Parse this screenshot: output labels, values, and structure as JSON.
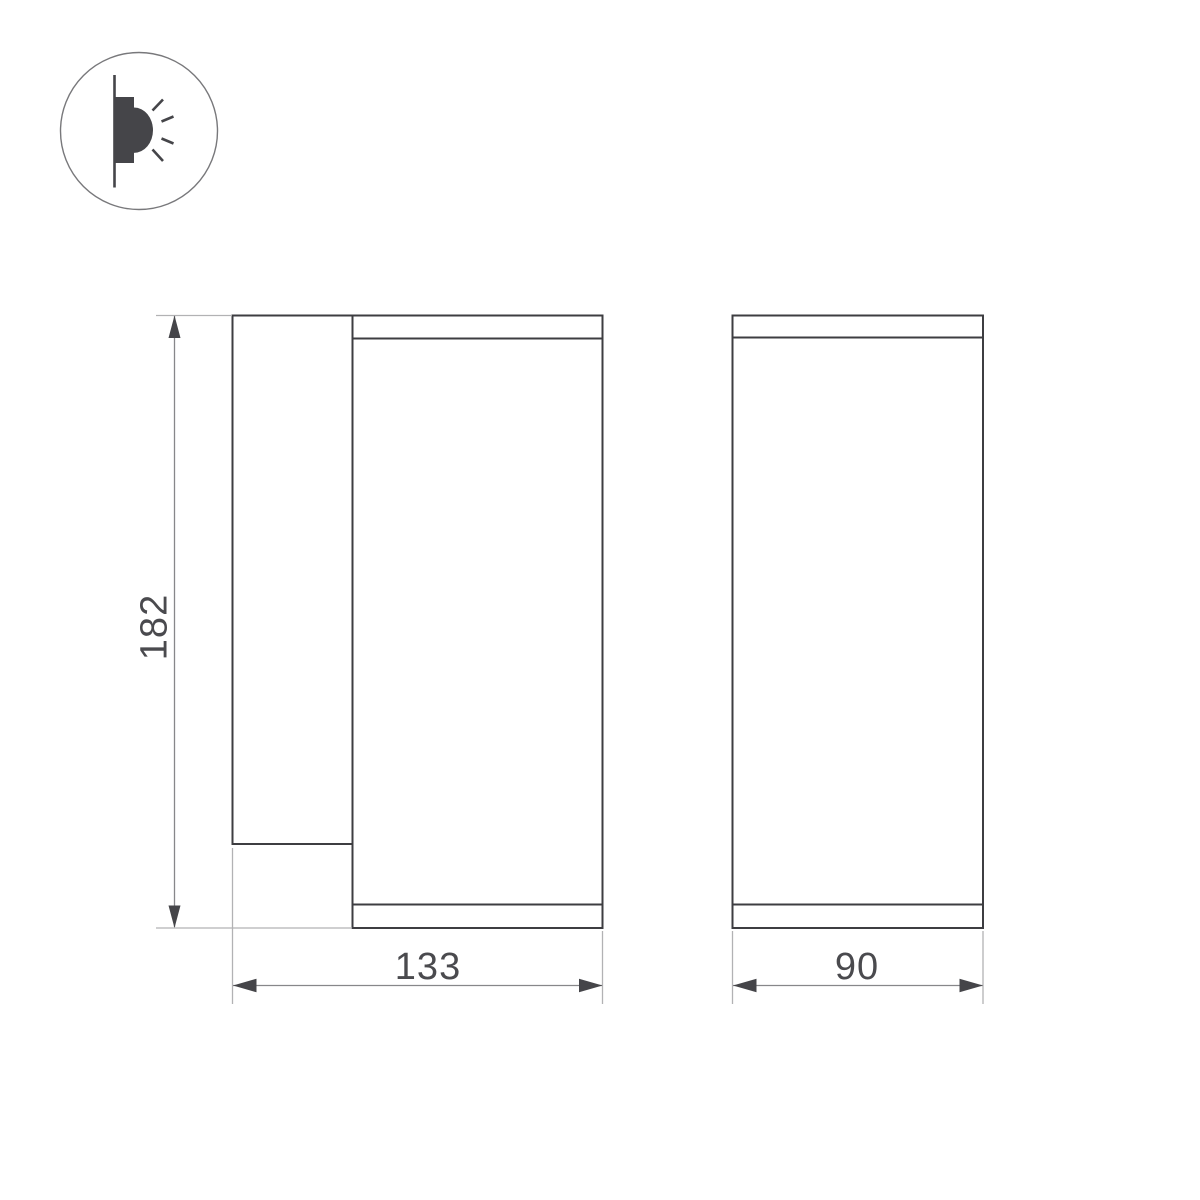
{
  "drawing": {
    "kind": "luminaire-dimension-drawing",
    "icon": {
      "name": "wall-light-side-emission-icon"
    },
    "dimensions": {
      "height": "182",
      "width": "133",
      "depth": "90"
    },
    "colors": {
      "background": "#ffffff",
      "outline": "#3d3d41",
      "dimension_line": "#87878a",
      "extension_line": "#b2b2b4",
      "arrow": "#454549",
      "text": "#4a4a4e"
    }
  }
}
